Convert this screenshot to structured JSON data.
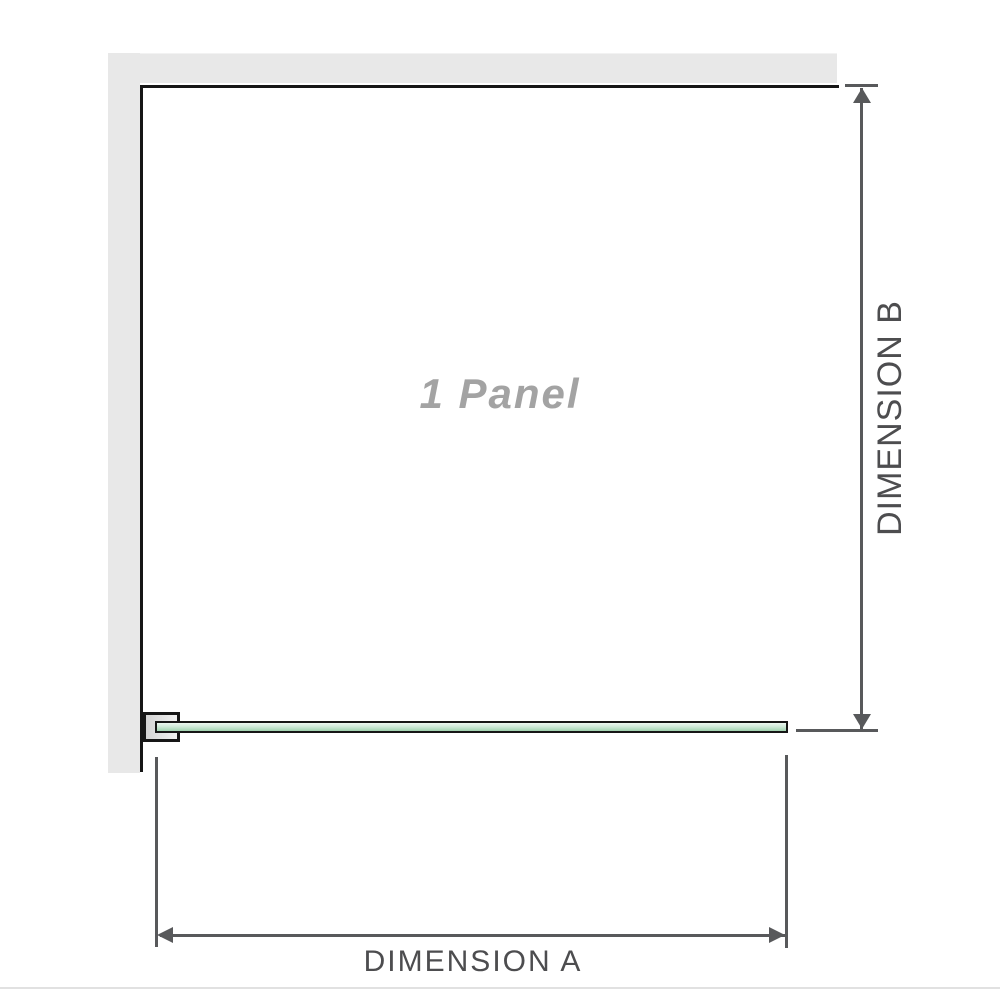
{
  "colors": {
    "wall": "#e8e8e8",
    "panel_outline": "#161616",
    "glass_light": "#edf7f0",
    "glass_dark": "#9fd2ae",
    "bracket_fill": "#d4d4d4",
    "dimension_line": "#58595b",
    "label_text": "#4d4d4f",
    "panel_label_text": "#a3a3a3",
    "divider": "#e1e1e1"
  },
  "diagram": {
    "panel_label": "1 Panel",
    "dimension_a": {
      "label": "DIMENSION A"
    },
    "dimension_b": {
      "label": "DIMENSION B"
    },
    "icons": {
      "arrow_up": "triangle-up",
      "arrow_down": "triangle-down",
      "arrow_left": "triangle-left",
      "arrow_right": "triangle-right"
    }
  }
}
